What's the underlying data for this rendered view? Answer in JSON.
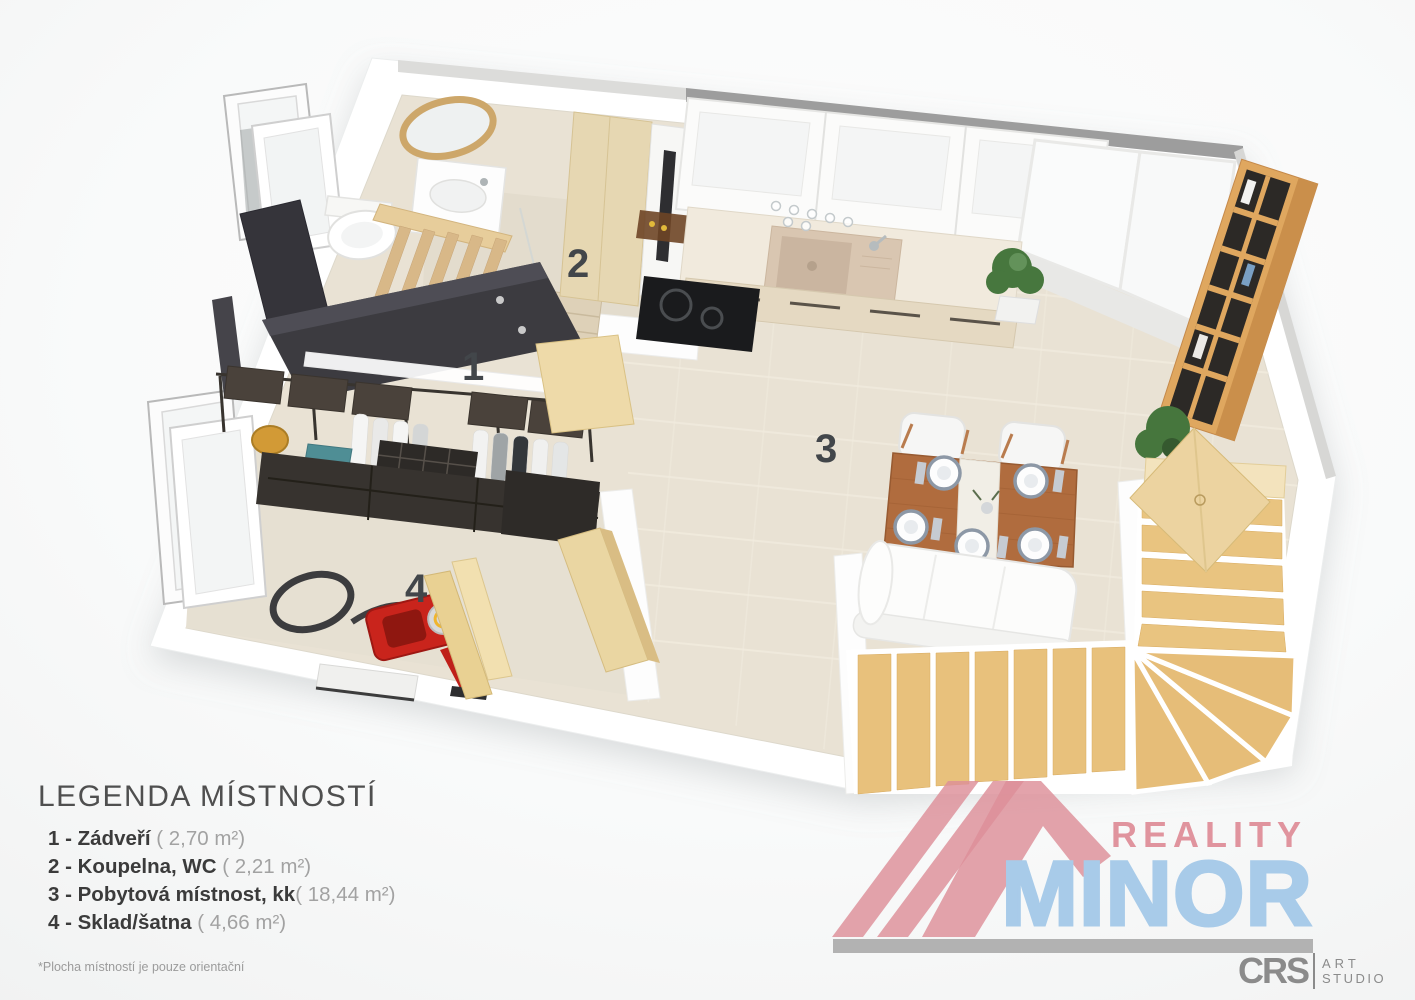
{
  "page": {
    "background": "#ffffff"
  },
  "rooms": [
    {
      "number": "1",
      "name": "Zádveří",
      "area": "2,70 m²"
    },
    {
      "number": "2",
      "name": "Koupelna, WC",
      "area": "2,21 m²"
    },
    {
      "number": "3",
      "name": "Pobytová místnost, kk",
      "area": "18,44 m²"
    },
    {
      "number": "4",
      "name": "Sklad/šatna",
      "area": "4,66 m²"
    }
  ],
  "legend": {
    "title": "LEGENDA MÍSTNOSTÍ",
    "items": [
      {
        "bold": "1 - Zádveří",
        "area": " ( 2,70 m²)"
      },
      {
        "bold": "2 - Koupelna, WC",
        "area": " ( 2,21 m²)"
      },
      {
        "bold": "3 - Pobytová místnost, kk",
        "area": "( 18,44 m²)"
      },
      {
        "bold": "4 - Sklad/šatna",
        "area": " ( 4,66 m²)"
      }
    ]
  },
  "branding": {
    "reality": "REALITY",
    "minor": "MINOR",
    "studio": {
      "name": "CRS",
      "line1": "ART",
      "line2": "STUDIO"
    },
    "colors": {
      "reality_pink": "#e0949e",
      "minor_blue": "#a8cbe9",
      "roof_pink": "#dd8f99",
      "bar_gray": "#b2b2b2",
      "studio_gray": "#8b8b8b"
    }
  },
  "footnote": "*Plocha místností je pouze orientační",
  "plan_colors": {
    "floor": "#e9e2d4",
    "bathroom_floor": "#e3dccd",
    "wall": "#ffffff",
    "wood_stairs": "#e8c17c",
    "wood_shelf": "#dfa75f",
    "wood_doors": "#ead6a2",
    "dark_furniture": "#37332f",
    "counter": "#f1eadd",
    "sink_tan": "#d9c6b1",
    "table_wood": "#b06c3e",
    "accent_red": "#c9241c",
    "accent_teal": "#4f8e95",
    "accent_amber": "#d29a36",
    "label_gray": "#42464a"
  }
}
